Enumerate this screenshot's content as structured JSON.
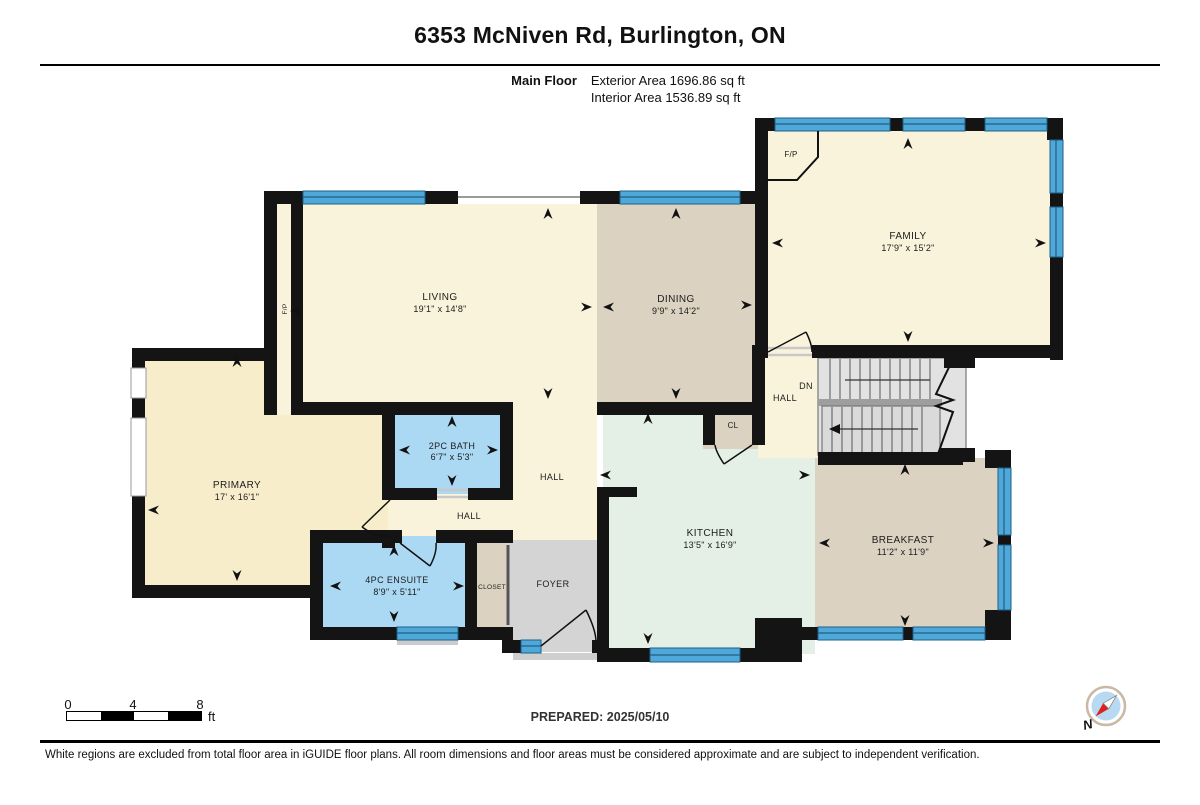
{
  "header": {
    "title": "6353 McNiven Rd, Burlington, ON",
    "floor_label": "Main Floor",
    "exterior_area": "Exterior Area 1696.86 sq ft",
    "interior_area": "Interior Area 1536.89 sq ft"
  },
  "rooms": {
    "family": {
      "name": "FAMILY",
      "dims": "17'9\" x 15'2\""
    },
    "living": {
      "name": "LIVING",
      "dims": "19'1\" x 14'8\""
    },
    "dining": {
      "name": "DINING",
      "dims": "9'9\" x 14'2\""
    },
    "primary": {
      "name": "PRIMARY",
      "dims": "17' x 16'1\""
    },
    "bath2pc": {
      "name": "2PC BATH",
      "dims": "6'7\" x 5'3\""
    },
    "ensuite": {
      "name": "4PC ENSUITE",
      "dims": "8'9\" x 5'11\""
    },
    "kitchen": {
      "name": "KITCHEN",
      "dims": "13'5\" x 16'9\""
    },
    "breakfast": {
      "name": "BREAKFAST",
      "dims": "11'2\" x 11'9\""
    },
    "hall_main": {
      "name": "HALL"
    },
    "hall_small": {
      "name": "HALL"
    },
    "hall_stairs": {
      "name": "HALL"
    },
    "dn": {
      "name": "DN"
    },
    "foyer": {
      "name": "FOYER"
    },
    "closet": {
      "name": "CLOSET"
    },
    "cl": {
      "name": "CL"
    },
    "fp_family": {
      "name": "F/P"
    },
    "fp_living": {
      "name": "F/P"
    }
  },
  "scale": {
    "t0": "0",
    "t4": "4",
    "t8": "8",
    "unit": "ft"
  },
  "prepared": "PREPARED: 2025/05/10",
  "compass": {
    "label": "N"
  },
  "disclaimer": "White regions are excluded from total floor area in iGUIDE floor plans. All room dimensions and floor areas must be considered approximate and are subject to independent verification.",
  "colors": {
    "wall": "#141414",
    "window_blue": "#4FA8D8",
    "window_line": "#1E5F87",
    "cream": "#FAF3DC",
    "primary_cream": "#F7EDCB",
    "tan": "#DBD2C1",
    "bath_blue": "#ABD9F3",
    "kitchen_mint": "#E4EFE5",
    "foyer_gray": "#D4D4D4",
    "stairs_gray": "#E2E2E2",
    "compass_red": "#E02020",
    "compass_blue": "#B8D9F2"
  }
}
